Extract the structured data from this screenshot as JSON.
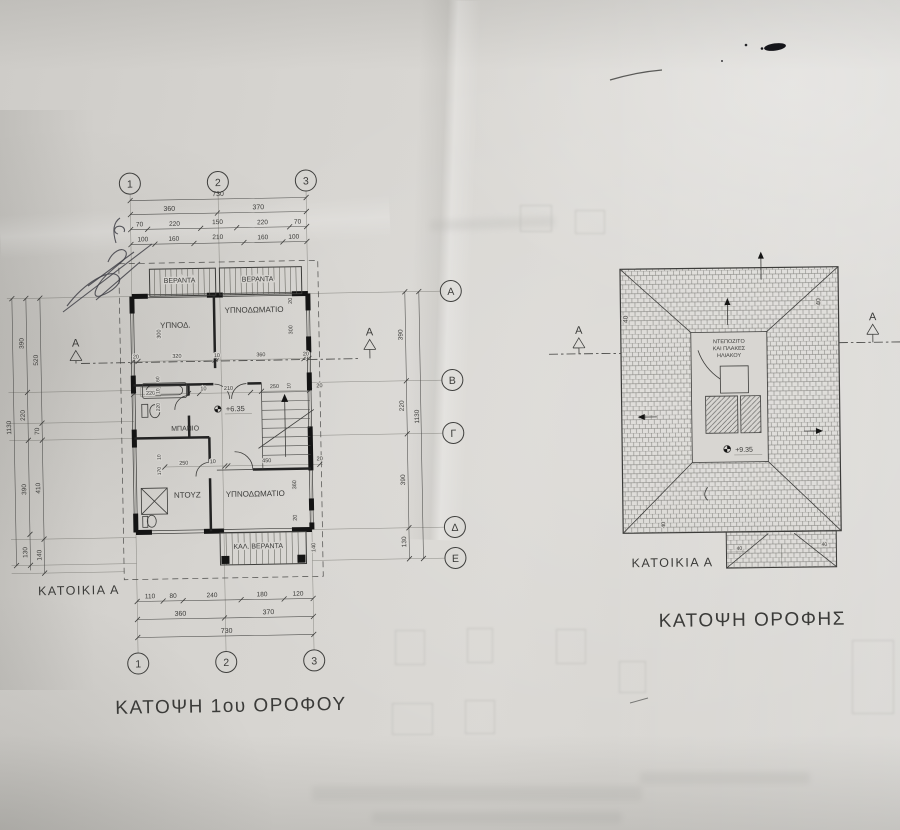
{
  "floor_plan": {
    "title": "ΚΑΤΟΨΗ 1ου ΟΡΟΦΟΥ",
    "house_label": "ΚΑΤΟΙΚΙΑ Α",
    "level": "+6.35",
    "section_label": "A",
    "grid_cols": [
      "1",
      "2",
      "3"
    ],
    "grid_rows": [
      "A",
      "B",
      "Γ",
      "Δ",
      "E"
    ],
    "rooms": {
      "veranda_left": "ΒΕΡΑΝΤΑ",
      "veranda_right": "ΒΕΡΑΝΤΑ",
      "bedroom_small": "ΥΠΝΟΔ.",
      "bedroom_top": "ΥΠΝΟΔΩΜΑΤΙΟ",
      "bathroom": "ΜΠΑΝΙΟ",
      "shower": "ΝΤΟΥΖ",
      "bedroom_bottom": "ΥΠΝΟΔΩΜΑΤΙΟ",
      "covered_veranda": "ΚΑΛ. ΒΕΡΑΝΤΑ"
    },
    "dims_top": {
      "total": "730",
      "bays": [
        "360",
        "370"
      ],
      "chain3": [
        "70",
        "220",
        "150",
        "220",
        "70"
      ],
      "chain4": [
        "100",
        "160",
        "210",
        "160",
        "100"
      ]
    },
    "dims_bottom": {
      "chain1": [
        "110",
        "80",
        "240",
        "180",
        "120"
      ],
      "bays": [
        "360",
        "370"
      ],
      "total": "730"
    },
    "dims_left": {
      "total": "1130",
      "chain1": [
        "390",
        "220",
        "390",
        "130"
      ],
      "chain2": [
        "520",
        "70",
        "410",
        "140"
      ]
    },
    "dims_right": {
      "total": "1130",
      "chain": [
        "390",
        "220",
        "390",
        "130"
      ]
    },
    "interior_dims": {
      "row_b": [
        "20",
        "320",
        "10",
        "360",
        "20"
      ],
      "bath_row": [
        "220",
        "10",
        "210"
      ],
      "bath_col": [
        "60",
        "10",
        "220"
      ],
      "stair_row": [
        "250",
        "10",
        "20"
      ],
      "mid_row": [
        "250",
        "10",
        "450",
        "20"
      ],
      "low_col": [
        "10",
        "170"
      ],
      "right_col_top": [
        "20",
        "300"
      ],
      "right_col_bottom": [
        "360",
        "20"
      ],
      "room_h_left": "300",
      "veranda_h": "140"
    }
  },
  "roof_plan": {
    "title": "ΚΑΤΟΨΗ ΟΡΟΦΗΣ",
    "house_label": "ΚΑΤΟΙΚΙΑ Α",
    "level": "+9.35",
    "center_label_lines": [
      "ΝΤΕΠΟΖΙΤΟ",
      "ΚΑΙ ΠΛΑΚΕΣ",
      "ΗΛΙΑΚΟΥ"
    ],
    "eave_offset": "40",
    "section_label": "A"
  },
  "colors": {
    "paper": "#d6d4d0",
    "line": "#4b4b49",
    "wall": "#141414",
    "ink": "#3f3f46"
  }
}
